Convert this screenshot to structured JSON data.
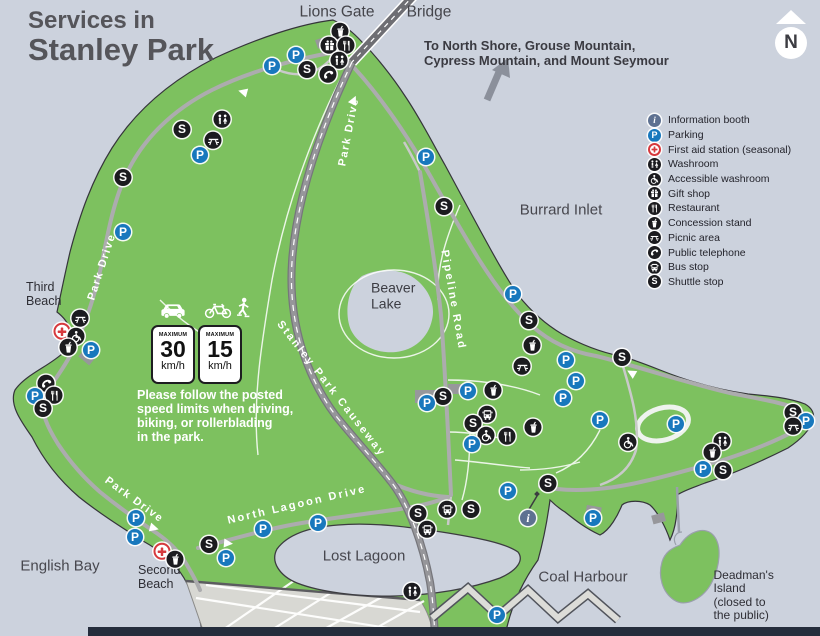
{
  "title": {
    "line1": "Services in",
    "line2": "Stanley Park"
  },
  "compass": {
    "label": "N"
  },
  "direction_note": {
    "line1": "To North Shore, Grouse Mountain,",
    "line2": "Cypress Mountain, and Mount Seymour"
  },
  "colors": {
    "water": "#ccd2dd",
    "park_green": "#7dc15f",
    "parking_blue": "#1878bd",
    "info_slate": "#5e7191",
    "first_aid_red": "#d6393d",
    "marker_black": "#1b1b1f",
    "dark_band": "#252d3c"
  },
  "icon_defs": {
    "info": {
      "bg": "#5e7191",
      "glyph": "i",
      "serif": true
    },
    "parking": {
      "bg": "#1878bd",
      "glyph": "P"
    },
    "firstaid": {
      "bg": "#ffffff",
      "sym": "cross",
      "ring": "#d6393d"
    },
    "washroom": {
      "bg": "#1b1b1f",
      "sym": "washroom"
    },
    "accessible": {
      "bg": "#1b1b1f",
      "sym": "accessible"
    },
    "gift": {
      "bg": "#1b1b1f",
      "sym": "gift"
    },
    "restaurant": {
      "bg": "#1b1b1f",
      "sym": "restaurant"
    },
    "concession": {
      "bg": "#1b1b1f",
      "sym": "concession"
    },
    "picnic": {
      "bg": "#1b1b1f",
      "sym": "picnic"
    },
    "phone": {
      "bg": "#1b1b1f",
      "sym": "phone"
    },
    "bus": {
      "bg": "#1b1b1f",
      "sym": "bus"
    },
    "shuttle": {
      "bg": "#1b1b1f",
      "glyph": "S"
    }
  },
  "legend": {
    "items": [
      {
        "icon": "info",
        "label": "Information booth"
      },
      {
        "icon": "parking",
        "label": "Parking"
      },
      {
        "icon": "firstaid",
        "label": "First aid station (seasonal)"
      },
      {
        "icon": "washroom",
        "label": "Washroom"
      },
      {
        "icon": "accessible",
        "label": "Accessible washroom"
      },
      {
        "icon": "gift",
        "label": "Gift shop"
      },
      {
        "icon": "restaurant",
        "label": "Restaurant"
      },
      {
        "icon": "concession",
        "label": "Concession stand"
      },
      {
        "icon": "picnic",
        "label": "Picnic area"
      },
      {
        "icon": "phone",
        "label": "Public telephone"
      },
      {
        "icon": "bus",
        "label": "Bus stop"
      },
      {
        "icon": "shuttle",
        "label": "Shuttle stop"
      }
    ]
  },
  "speed_panel": {
    "signs": [
      {
        "top": "MAXIMUM",
        "value": "30",
        "unit": "km/h"
      },
      {
        "top": "MAXIMUM",
        "value": "15",
        "unit": "km/h"
      }
    ],
    "note": "Please follow the posted\nspeed limits when driving,\nbiking, or rollerblading\nin the park."
  },
  "map": {
    "labels": [
      {
        "name": "lions-gate-label",
        "text": "Lions Gate",
        "x": 337,
        "y": 12,
        "cls": "lbl-bridge"
      },
      {
        "name": "bridge-label",
        "text": "Bridge",
        "x": 429,
        "y": 12,
        "cls": "lbl-bridge"
      },
      {
        "name": "burrard-inlet",
        "text": "Burrard Inlet",
        "x": 561,
        "y": 211,
        "cls": "lbl-water-lg"
      },
      {
        "name": "english-bay",
        "text": "English Bay",
        "x": 60,
        "y": 567,
        "cls": "lbl-water-lg"
      },
      {
        "name": "coal-harbour",
        "text": "Coal Harbour",
        "x": 583,
        "y": 578,
        "cls": "lbl-water-lg"
      },
      {
        "name": "lost-lagoon",
        "text": "Lost Lagoon",
        "x": 364,
        "y": 557,
        "cls": "lbl-water-lg"
      },
      {
        "name": "beaver-lake",
        "text": "Beaver\nLake",
        "x": 371,
        "y": 296,
        "cls": "lbl-water-md",
        "a": "l"
      },
      {
        "name": "third-beach",
        "text": "Third\nBeach",
        "x": 26,
        "y": 294,
        "cls": "lbl-place",
        "a": "l"
      },
      {
        "name": "second-beach",
        "text": "Second\nBeach",
        "x": 138,
        "y": 577,
        "cls": "lbl-place",
        "a": "l"
      },
      {
        "name": "deadmans-island",
        "text": "Deadman's Island\n(closed to the public)",
        "x": 749,
        "y": 596,
        "cls": "lbl-place-sm"
      },
      {
        "name": "park-drive-left",
        "text": "Park Drive",
        "x": 102,
        "y": 267,
        "cls": "lbl-road",
        "rot": -72
      },
      {
        "name": "park-drive-top",
        "text": "Park Drive",
        "x": 349,
        "y": 132,
        "cls": "lbl-road",
        "rot": -79
      },
      {
        "name": "pipeline-road",
        "text": "Pipeline  Road",
        "x": 453,
        "y": 300,
        "cls": "lbl-road-wide",
        "rot": 80
      },
      {
        "name": "stanley-park-causeway",
        "text": "Stanley Park Causeway",
        "x": 331,
        "y": 389,
        "cls": "lbl-road-wide",
        "rot": 52
      },
      {
        "name": "north-lagoon-drive",
        "text": "North Lagoon Drive",
        "x": 297,
        "y": 505,
        "cls": "lbl-road-wide",
        "rot": -13
      },
      {
        "name": "park-drive-southwest",
        "text": "Park Drive",
        "x": 134,
        "y": 500,
        "cls": "lbl-road",
        "rot": 36
      }
    ],
    "markers": [
      {
        "icon": "concession",
        "x": 340,
        "y": 33
      },
      {
        "icon": "gift",
        "x": 329,
        "y": 47
      },
      {
        "icon": "restaurant",
        "x": 346,
        "y": 47
      },
      {
        "icon": "washroom",
        "x": 339,
        "y": 62
      },
      {
        "icon": "parking",
        "x": 296,
        "y": 55
      },
      {
        "icon": "parking",
        "x": 272,
        "y": 66
      },
      {
        "icon": "shuttle",
        "x": 307,
        "y": 69
      },
      {
        "icon": "phone",
        "x": 328,
        "y": 76
      },
      {
        "icon": "washroom",
        "x": 222,
        "y": 121
      },
      {
        "icon": "shuttle",
        "x": 182,
        "y": 129
      },
      {
        "icon": "picnic",
        "x": 213,
        "y": 142
      },
      {
        "icon": "parking",
        "x": 200,
        "y": 155
      },
      {
        "icon": "shuttle",
        "x": 123,
        "y": 177
      },
      {
        "icon": "parking",
        "x": 123,
        "y": 232
      },
      {
        "icon": "parking",
        "x": 426,
        "y": 157
      },
      {
        "icon": "shuttle",
        "x": 444,
        "y": 206
      },
      {
        "icon": "picnic",
        "x": 80,
        "y": 320
      },
      {
        "icon": "firstaid",
        "x": 62,
        "y": 333
      },
      {
        "icon": "accessible",
        "x": 76,
        "y": 338
      },
      {
        "icon": "concession",
        "x": 68,
        "y": 349
      },
      {
        "icon": "parking",
        "x": 91,
        "y": 350
      },
      {
        "icon": "phone",
        "x": 46,
        "y": 385
      },
      {
        "icon": "parking",
        "x": 35,
        "y": 396
      },
      {
        "icon": "restaurant",
        "x": 54,
        "y": 397
      },
      {
        "icon": "shuttle",
        "x": 43,
        "y": 408
      },
      {
        "icon": "parking",
        "x": 513,
        "y": 294
      },
      {
        "icon": "shuttle",
        "x": 529,
        "y": 320
      },
      {
        "icon": "concession",
        "x": 532,
        "y": 347
      },
      {
        "icon": "picnic",
        "x": 522,
        "y": 368
      },
      {
        "icon": "parking",
        "x": 566,
        "y": 360
      },
      {
        "icon": "parking",
        "x": 576,
        "y": 381
      },
      {
        "icon": "parking",
        "x": 563,
        "y": 398
      },
      {
        "icon": "parking",
        "x": 600,
        "y": 420
      },
      {
        "icon": "shuttle",
        "x": 622,
        "y": 357
      },
      {
        "icon": "concession",
        "x": 493,
        "y": 392
      },
      {
        "icon": "parking",
        "x": 468,
        "y": 391
      },
      {
        "icon": "shuttle",
        "x": 443,
        "y": 396
      },
      {
        "icon": "parking",
        "x": 427,
        "y": 403
      },
      {
        "icon": "bus",
        "x": 487,
        "y": 416
      },
      {
        "icon": "shuttle",
        "x": 473,
        "y": 423
      },
      {
        "icon": "accessible",
        "x": 486,
        "y": 437
      },
      {
        "icon": "restaurant",
        "x": 507,
        "y": 438
      },
      {
        "icon": "concession",
        "x": 533,
        "y": 429
      },
      {
        "icon": "parking",
        "x": 472,
        "y": 444
      },
      {
        "icon": "parking",
        "x": 508,
        "y": 491
      },
      {
        "icon": "accessible",
        "x": 628,
        "y": 444
      },
      {
        "icon": "shuttle",
        "x": 548,
        "y": 483
      },
      {
        "icon": "shuttle",
        "x": 418,
        "y": 513
      },
      {
        "icon": "bus",
        "x": 447,
        "y": 511
      },
      {
        "icon": "shuttle",
        "x": 471,
        "y": 509
      },
      {
        "icon": "bus",
        "x": 427,
        "y": 531
      },
      {
        "icon": "info",
        "x": 528,
        "y": 518
      },
      {
        "icon": "parking",
        "x": 593,
        "y": 518
      },
      {
        "icon": "parking",
        "x": 497,
        "y": 615
      },
      {
        "icon": "washroom",
        "x": 412,
        "y": 593
      },
      {
        "icon": "parking",
        "x": 676,
        "y": 424
      },
      {
        "icon": "washroom",
        "x": 722,
        "y": 443
      },
      {
        "icon": "concession",
        "x": 712,
        "y": 454
      },
      {
        "icon": "parking",
        "x": 703,
        "y": 469
      },
      {
        "icon": "shuttle",
        "x": 723,
        "y": 470
      },
      {
        "icon": "shuttle",
        "x": 793,
        "y": 412
      },
      {
        "icon": "parking",
        "x": 806,
        "y": 421
      },
      {
        "icon": "picnic",
        "x": 793,
        "y": 428
      },
      {
        "icon": "parking",
        "x": 136,
        "y": 518
      },
      {
        "icon": "parking",
        "x": 135,
        "y": 537
      },
      {
        "icon": "firstaid",
        "x": 162,
        "y": 553
      },
      {
        "icon": "concession",
        "x": 175,
        "y": 561
      },
      {
        "icon": "shuttle",
        "x": 209,
        "y": 544
      },
      {
        "icon": "parking",
        "x": 226,
        "y": 558
      },
      {
        "icon": "parking",
        "x": 263,
        "y": 529
      },
      {
        "icon": "parking",
        "x": 318,
        "y": 523
      }
    ]
  }
}
